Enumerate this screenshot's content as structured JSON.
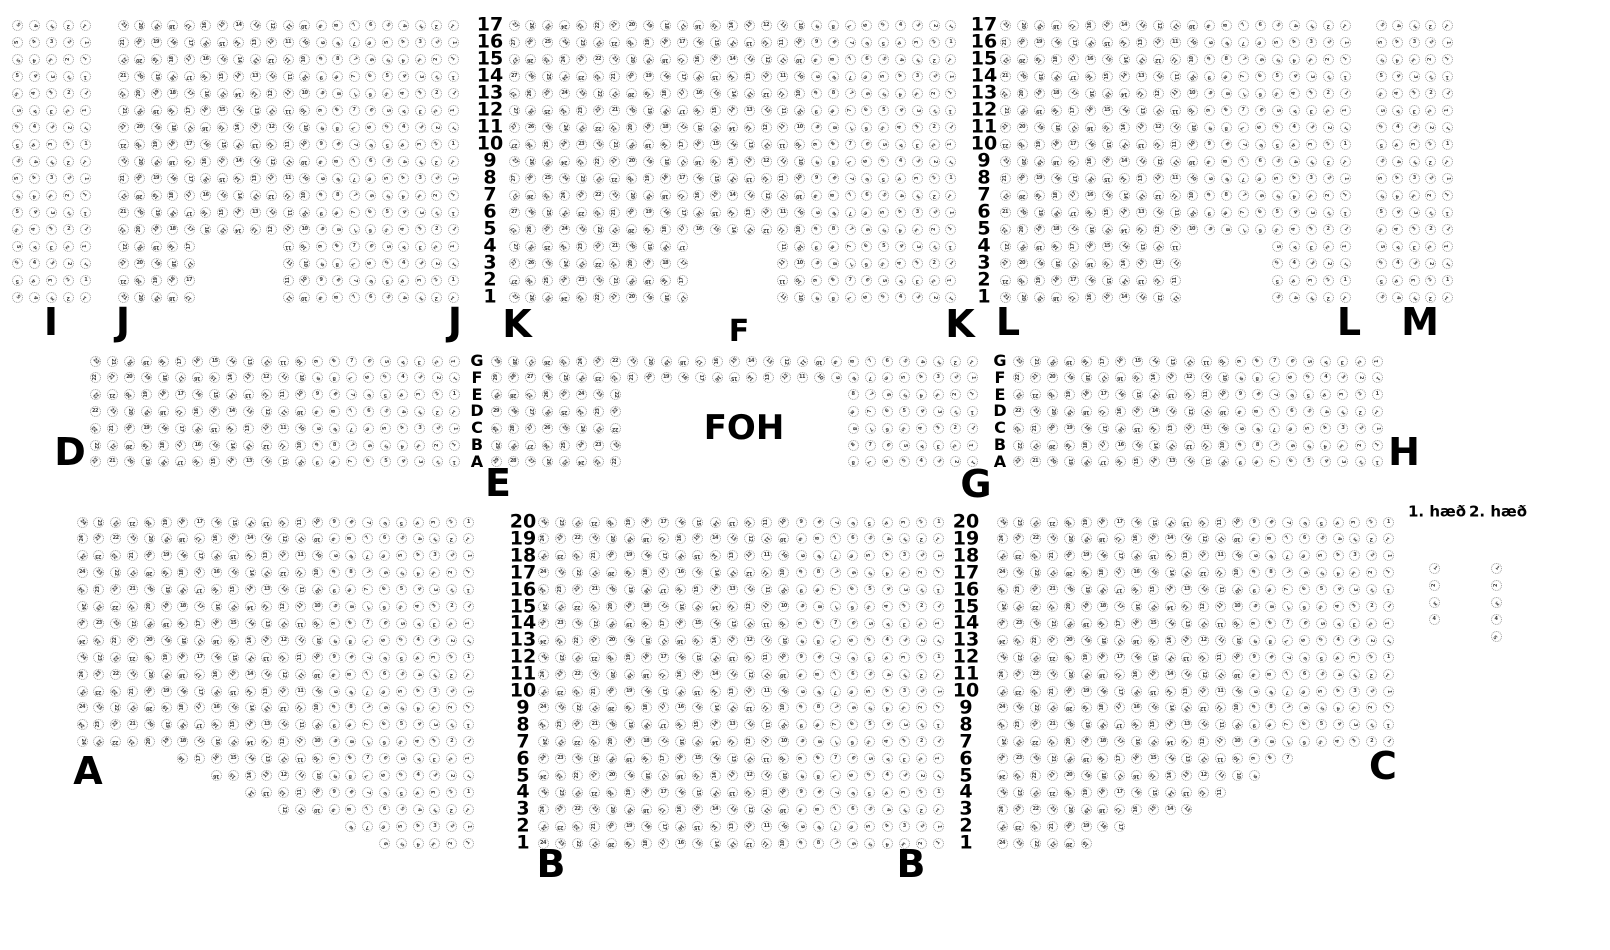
{
  "page_background": "#ffffff",
  "text_color": "#000000",
  "seat_style": {
    "outline_color": "#979797",
    "digit_color": "#3a3a3a"
  },
  "foh": {
    "text": "FOH",
    "x": 744,
    "y": 428
  },
  "legend": {
    "labels": [
      {
        "text": "1. hæð",
        "x": 1437,
        "y": 512
      },
      {
        "text": "2. hæð",
        "x": 1498,
        "y": 512
      }
    ]
  },
  "section_labels": [
    {
      "text": "I",
      "x": 51,
      "y": 322
    },
    {
      "text": "J",
      "x": 123,
      "y": 322
    },
    {
      "text": "J",
      "x": 455,
      "y": 322
    },
    {
      "text": "K",
      "x": 517,
      "y": 324
    },
    {
      "text": "K",
      "x": 960,
      "y": 324
    },
    {
      "text": "F",
      "x": 739,
      "y": 332,
      "font_size": 30
    },
    {
      "text": "L",
      "x": 1008,
      "y": 322
    },
    {
      "text": "L",
      "x": 1349,
      "y": 322
    },
    {
      "text": "M",
      "x": 1420,
      "y": 322
    },
    {
      "text": "D",
      "x": 70,
      "y": 452
    },
    {
      "text": "E",
      "x": 498,
      "y": 483
    },
    {
      "text": "G",
      "x": 976,
      "y": 484
    },
    {
      "text": "H",
      "x": 1404,
      "y": 452
    },
    {
      "text": "A",
      "x": 88,
      "y": 771
    },
    {
      "text": "B",
      "x": 551,
      "y": 864
    },
    {
      "text": "B",
      "x": 911,
      "y": 864
    },
    {
      "text": "C",
      "x": 1383,
      "y": 766
    }
  ],
  "row_guides": [
    {
      "name": "top-left-row-numbers",
      "x": 490,
      "y": 25,
      "dy": 17,
      "font_size": 19,
      "labels": [
        "17",
        "16",
        "15",
        "14",
        "13",
        "12",
        "11",
        "10",
        "9",
        "8",
        "7",
        "6",
        "5",
        "4",
        "3",
        "2",
        "1"
      ]
    },
    {
      "name": "top-right-row-numbers",
      "x": 984,
      "y": 25,
      "dy": 17,
      "font_size": 19,
      "labels": [
        "17",
        "16",
        "15",
        "14",
        "13",
        "12",
        "11",
        "10",
        "9",
        "8",
        "7",
        "6",
        "5",
        "4",
        "3",
        "2",
        "1"
      ]
    },
    {
      "name": "middle-left-row-letters",
      "x": 477,
      "y": 361,
      "dy": 16.8,
      "font_size": 16,
      "labels": [
        "G",
        "F",
        "E",
        "D",
        "C",
        "B",
        "A"
      ]
    },
    {
      "name": "middle-right-row-letters",
      "x": 1000,
      "y": 361,
      "dy": 16.8,
      "font_size": 16,
      "labels": [
        "G",
        "F",
        "E",
        "D",
        "C",
        "B",
        "A"
      ]
    },
    {
      "name": "bottom-left-row-numbers",
      "x": 523,
      "y": 522,
      "dy": 16.9,
      "font_size": 19,
      "labels": [
        "20",
        "19",
        "18",
        "17",
        "16",
        "15",
        "14",
        "13",
        "12",
        "11",
        "10",
        "9",
        "8",
        "7",
        "6",
        "5",
        "4",
        "3",
        "2",
        "1"
      ]
    },
    {
      "name": "bottom-right-row-numbers",
      "x": 966,
      "y": 522,
      "dy": 16.9,
      "font_size": 19,
      "labels": [
        "20",
        "19",
        "18",
        "17",
        "16",
        "15",
        "14",
        "13",
        "12",
        "11",
        "10",
        "9",
        "8",
        "7",
        "6",
        "5",
        "4",
        "3",
        "2",
        "1"
      ]
    }
  ],
  "sections": [
    {
      "name": "I",
      "x": 17,
      "y": 25,
      "dx": 17.2,
      "dy": 17,
      "cols": 5,
      "rows": 17
    },
    {
      "name": "J",
      "x": 123,
      "y": 25,
      "dx": 16.5,
      "dy": 17,
      "cols": 21,
      "rows": 17,
      "row_spans_from_bottom": {
        "1": [
          [
            1,
            5
          ],
          [
            11,
            21
          ]
        ],
        "2": [
          [
            1,
            5
          ],
          [
            11,
            21
          ]
        ],
        "3": [
          [
            1,
            5
          ],
          [
            11,
            21
          ]
        ],
        "4": [
          [
            1,
            5
          ],
          [
            11,
            21
          ]
        ]
      }
    },
    {
      "name": "K",
      "x": 514,
      "y": 25,
      "dx": 16.8,
      "dy": 17,
      "cols": 27,
      "rows": 17,
      "row_spans_from_bottom": {
        "1": [
          [
            1,
            11
          ],
          [
            17,
            27
          ]
        ],
        "2": [
          [
            1,
            11
          ],
          [
            17,
            27
          ]
        ],
        "3": [
          [
            1,
            11
          ],
          [
            17,
            27
          ]
        ],
        "4": [
          [
            1,
            11
          ],
          [
            17,
            27
          ]
        ]
      }
    },
    {
      "name": "L",
      "x": 1005,
      "y": 25,
      "dx": 17,
      "dy": 17,
      "cols": 21,
      "rows": 17,
      "row_spans_from_bottom": {
        "1": [
          [
            1,
            11
          ],
          [
            17,
            21
          ]
        ],
        "2": [
          [
            1,
            11
          ],
          [
            17,
            21
          ]
        ],
        "3": [
          [
            1,
            11
          ],
          [
            17,
            21
          ]
        ],
        "4": [
          [
            1,
            11
          ],
          [
            17,
            21
          ]
        ]
      }
    },
    {
      "name": "M",
      "x": 1381,
      "y": 25,
      "dx": 16.6,
      "dy": 17,
      "cols": 5,
      "rows": 17
    },
    {
      "name": "D",
      "x": 95,
      "y": 361,
      "dx": 17.1,
      "dy": 16.8,
      "cols": 22,
      "rows": 7
    },
    {
      "name": "EFG",
      "x": 496,
      "y": 361,
      "dx": 17,
      "dy": 16.8,
      "cols": 29,
      "rows": 7,
      "row_spans_from_bottom": {
        "1": [
          [
            1,
            8
          ],
          [
            22,
            29
          ]
        ],
        "2": [
          [
            1,
            8
          ],
          [
            22,
            29
          ]
        ],
        "3": [
          [
            1,
            8
          ],
          [
            22,
            29
          ]
        ],
        "4": [
          [
            1,
            8
          ],
          [
            22,
            29
          ]
        ],
        "5": [
          [
            1,
            8
          ],
          [
            22,
            29
          ]
        ]
      }
    },
    {
      "name": "H",
      "x": 1018,
      "y": 361,
      "dx": 17.1,
      "dy": 16.8,
      "cols": 22,
      "rows": 7
    },
    {
      "name": "A",
      "x": 82,
      "y": 522,
      "dx": 16.8,
      "dy": 16.9,
      "cols": 24,
      "rows": 20,
      "row_spans_from_bottom": {
        "1": [
          [
            19,
            24
          ]
        ],
        "2": [
          [
            17,
            24
          ]
        ],
        "3": [
          [
            13,
            24
          ]
        ],
        "4": [
          [
            11,
            24
          ]
        ],
        "5": [
          [
            9,
            24
          ]
        ],
        "6": [
          [
            7,
            24
          ]
        ]
      }
    },
    {
      "name": "B",
      "x": 543,
      "y": 522,
      "dx": 17.2,
      "dy": 16.9,
      "cols": 24,
      "rows": 20
    },
    {
      "name": "C",
      "x": 1002,
      "y": 522,
      "dx": 16.8,
      "dy": 16.9,
      "cols": 24,
      "rows": 20,
      "row_spans_from_bottom": {
        "1": [
          [
            1,
            6
          ]
        ],
        "2": [
          [
            1,
            8
          ]
        ],
        "3": [
          [
            1,
            12
          ]
        ],
        "4": [
          [
            1,
            14
          ]
        ],
        "5": [
          [
            1,
            16
          ]
        ],
        "6": [
          [
            1,
            18
          ]
        ]
      }
    },
    {
      "name": "legend-floor-1",
      "x": 1434,
      "y": 568,
      "dx": 17,
      "dy": 17,
      "cols": 1,
      "rows": 4,
      "number_mode": "row"
    },
    {
      "name": "legend-floor-2",
      "x": 1496,
      "y": 568,
      "dx": 17,
      "dy": 17,
      "cols": 1,
      "rows": 5,
      "number_mode": "row"
    }
  ]
}
